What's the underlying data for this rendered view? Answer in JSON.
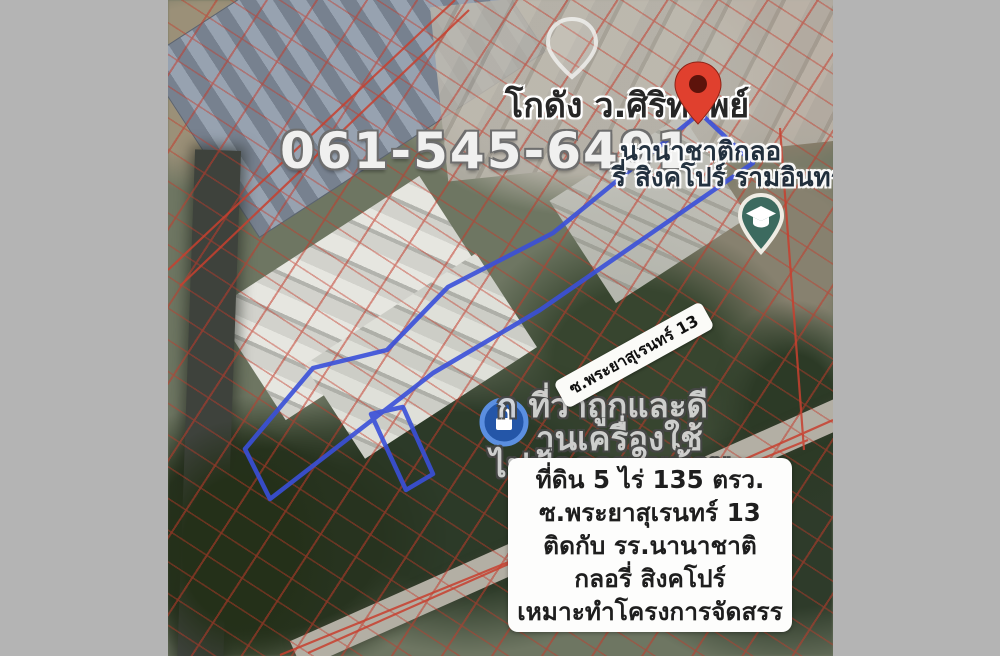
{
  "listing": {
    "phone_number": "061-545-6491",
    "pin_place_label": "โกดัง ว.ศิริทรัพย์",
    "place_label_line1": "นานาชาติกลอ",
    "place_label_line2": "รี่ สิงคโปร์ รามอินทรา",
    "street_sign_label": "ซ.พระยาสุเรนทร์ 13",
    "watermark_line1": "ก ที่ว่าถูกและดี",
    "watermark_line2": "านเครื่องใช้",
    "watermark_line3": "ไฟฟ้าภายในบ้าน",
    "info_box": {
      "lines": [
        "ที่ดิน 5 ไร่ 135 ตรว.",
        "ซ.พระยาสุเรนทร์ 13",
        "ติดกับ รร.นานาชาติ",
        "กลอรี่ สิงคโปร์",
        "เหมาะทำโครงการจัดสรร"
      ]
    },
    "icons": {
      "destination_pin": "red-map-pin",
      "school_poi": "graduation-cap-pin",
      "store_poi": "blue-lock-store-circle",
      "faded_poi": "ghost-pin-outline"
    },
    "colors": {
      "plot_outline_blue": "#3a50d9",
      "cadastral_red": "#c43a2b",
      "pin_red": "#e0402e",
      "school_teal": "#3c6a5f",
      "store_blue": "#2456a8",
      "letterbox_gray": "#b4b4b4",
      "info_box_bg": "#fdfdfc"
    }
  }
}
